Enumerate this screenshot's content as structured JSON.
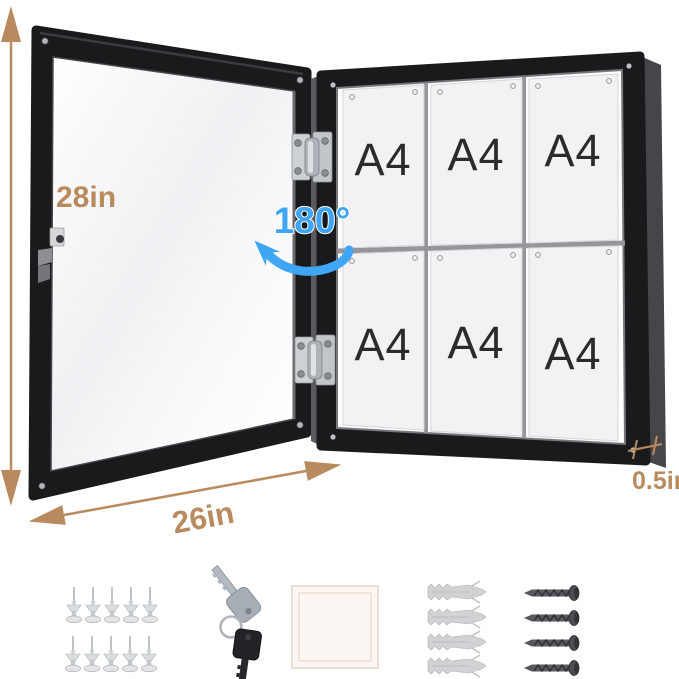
{
  "image": {
    "alt": "Open lockable enclosed bulletin board (black frame) holding six A4 sheets, with dimension callouts and included mounting accessories"
  },
  "dimensions": {
    "height": "28in",
    "width": "26in",
    "depth": "0.5in",
    "door_swing": "180°"
  },
  "board": {
    "rows": 2,
    "columns": 3,
    "papers": [
      "A4",
      "A4",
      "A4",
      "A4",
      "A4",
      "A4"
    ]
  },
  "accessories": {
    "push_pins": {
      "name": "push-pins",
      "count": 10
    },
    "keys": {
      "name": "keys",
      "count": 2
    },
    "adhesive_pad": {
      "name": "adhesive-pad",
      "count": 1
    },
    "wall_anchors": {
      "name": "wall-anchors",
      "count": 4
    },
    "screws": {
      "name": "screws",
      "count": 4
    }
  },
  "colors": {
    "dimension_accent": "#b88b5e",
    "swing_accent": "#3fa5f5",
    "frame": "#1a1a1d",
    "paper": "#f2f2f4"
  }
}
